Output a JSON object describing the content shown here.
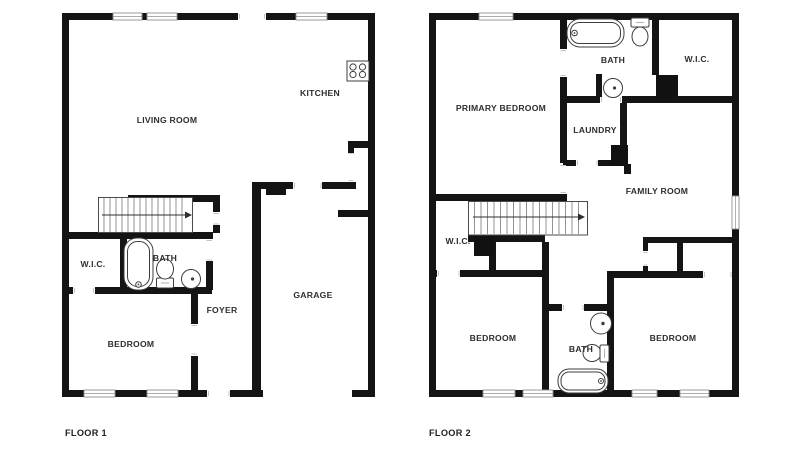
{
  "colors": {
    "wall": "#141414",
    "fixture_line": "#3d3d3d",
    "label_text": "#2e2e2e",
    "background": "#ffffff",
    "door_jamb": "#c4c4c4"
  },
  "floor1": {
    "floor_label": "FLOOR 1",
    "rooms": [
      {
        "id": "living-room",
        "label": "LIVING ROOM"
      },
      {
        "id": "kitchen",
        "label": "KITCHEN"
      },
      {
        "id": "wic",
        "label": "W.I.C."
      },
      {
        "id": "bath",
        "label": "BATH"
      },
      {
        "id": "bedroom",
        "label": "BEDROOM"
      },
      {
        "id": "foyer",
        "label": "FOYER"
      },
      {
        "id": "garage",
        "label": "GARAGE"
      }
    ],
    "fixtures": [
      "stove-icon",
      "bathtub-icon",
      "toilet-icon",
      "sink-icon",
      "staircase-up-arrow"
    ]
  },
  "floor2": {
    "floor_label": "FLOOR 2",
    "rooms": [
      {
        "id": "primary-bedroom",
        "label": "PRIMARY BEDROOM"
      },
      {
        "id": "bath-upper",
        "label": "BATH"
      },
      {
        "id": "wic-upper",
        "label": "W.I.C."
      },
      {
        "id": "laundry",
        "label": "LAUNDRY"
      },
      {
        "id": "family-room",
        "label": "FAMILY ROOM"
      },
      {
        "id": "wic-hall",
        "label": "W.I.C."
      },
      {
        "id": "bedroom-left",
        "label": "BEDROOM"
      },
      {
        "id": "bath-lower",
        "label": "BATH"
      },
      {
        "id": "bedroom-right",
        "label": "BEDROOM"
      }
    ],
    "fixtures": [
      "bathtub-icon",
      "toilet-icon",
      "sink-icon",
      "bathtub-icon",
      "toilet-icon",
      "sink-icon",
      "staircase-up-arrow"
    ]
  }
}
